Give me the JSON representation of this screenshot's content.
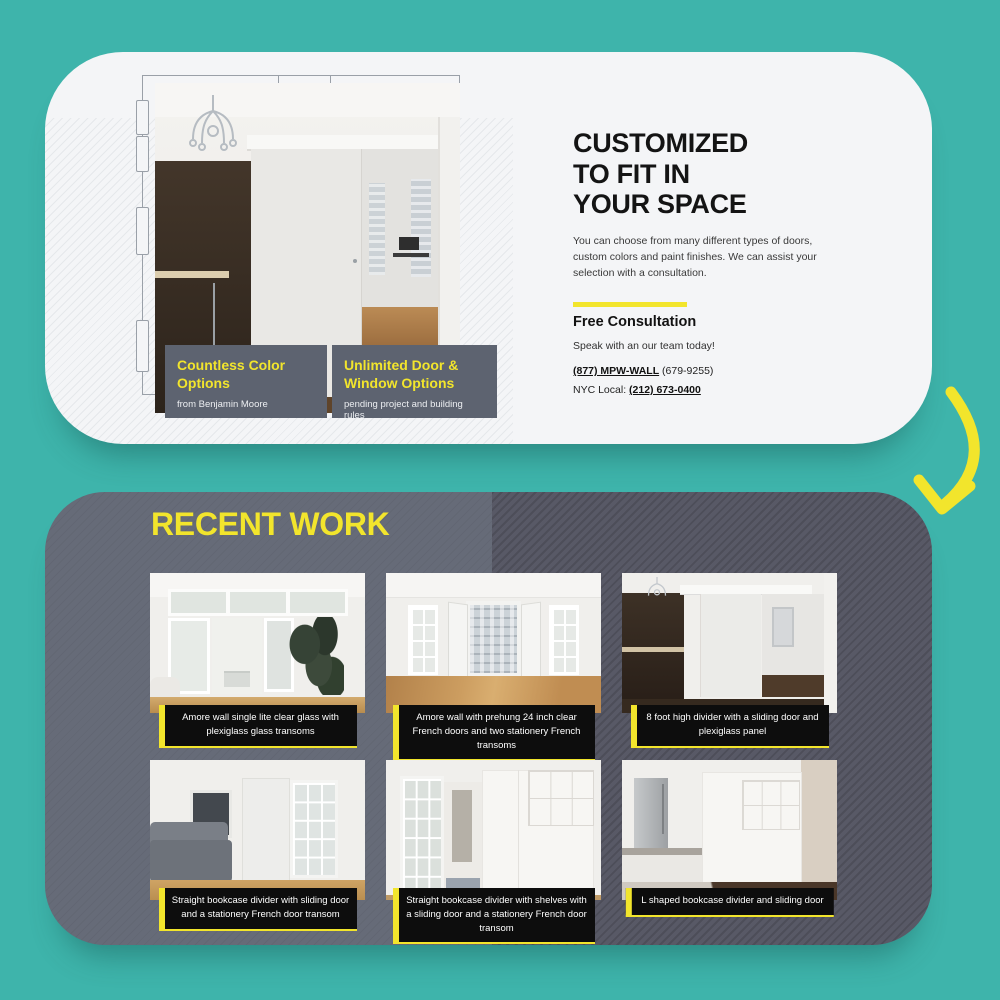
{
  "page": {
    "background_color": "#3eb4ab",
    "accent_yellow": "#f2e52c",
    "slate_gray": "#5d6370",
    "work_card_gray": "#666b78",
    "work_card_dark_gray": "#585966"
  },
  "hero_card": {
    "heading_lines": [
      "CUSTOMIZED",
      "TO FIT IN",
      "YOUR SPACE"
    ],
    "body_lines": [
      "You can choose from many different types of doors,",
      "custom colors and paint finishes. We can assist your",
      "selection with a consultation."
    ],
    "consultation": {
      "title": "Free Consultation",
      "subtitle": "Speak with an our team today!",
      "phone_main_bold": "(877) MPW-WALL",
      "phone_main_rest": " (679-9255)",
      "phone_local_label": "NYC Local: ",
      "phone_local_number": "(212) 673-0400"
    },
    "feature_cards": [
      {
        "title": "Countless Color Options",
        "subtitle": "from Benjamin Moore"
      },
      {
        "title": "Unlimited Door & Window Options",
        "subtitle": "pending project and building rules"
      }
    ]
  },
  "recent_work": {
    "heading": "RECENT WORK",
    "items": [
      {
        "caption": "Amore wall single lite clear glass with plexiglass glass transoms"
      },
      {
        "caption": "Amore wall with prehung 24 inch clear French doors and two stationery French transoms"
      },
      {
        "caption": "8 foot high divider with a sliding door and plexiglass panel"
      },
      {
        "caption": "Straight bookcase divider with sliding door and a stationery French door transom"
      },
      {
        "caption": "Straight bookcase divider with shelves with a sliding door and a stationery French door transom"
      },
      {
        "caption": "L shaped bookcase divider and sliding door"
      }
    ]
  }
}
